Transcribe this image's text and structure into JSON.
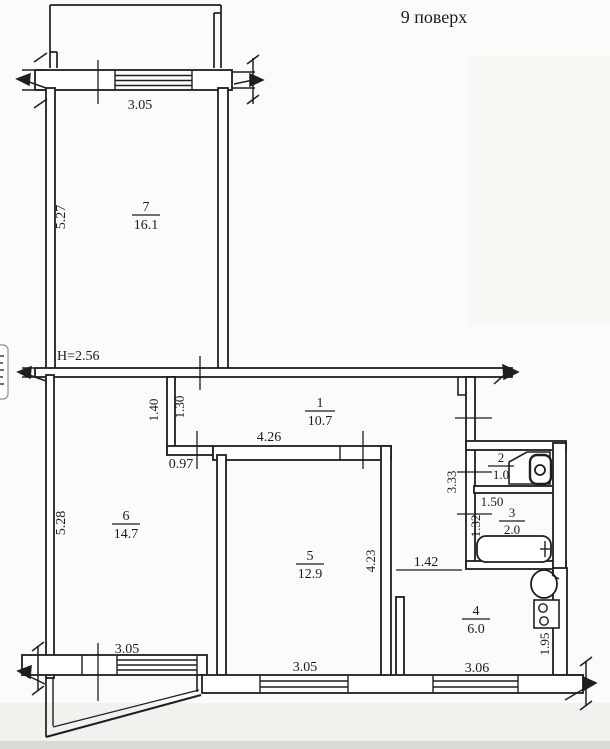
{
  "title": "9 поверх",
  "colors": {
    "ink": "#1c1c1c",
    "paper": "#fbfbf9"
  },
  "rooms": {
    "r1": {
      "number": "1",
      "area": "10.7"
    },
    "r2": {
      "number": "2",
      "area": "1.0"
    },
    "r3": {
      "number": "3",
      "area": "2.0"
    },
    "r4": {
      "number": "4",
      "area": "6.0"
    },
    "r5": {
      "number": "5",
      "area": "12.9"
    },
    "r6": {
      "number": "6",
      "area": "14.7"
    },
    "r7": {
      "number": "7",
      "area": "16.1"
    }
  },
  "dimensions": {
    "top_window": "3.05",
    "room7_side": "5.27",
    "ceiling_height": "H=2.56",
    "hall_1_40": "1.40",
    "hall_1_30": "1.30",
    "hall_4_26": "4.26",
    "hall_0_97": "0.97",
    "room6_side": "5.28",
    "room6_window": "3.05",
    "room5_side": "4.23",
    "room5_window": "3.05",
    "kitchen_pass": "1.42",
    "kitchen_window": "3.06",
    "kitchen_1_95": "1.95",
    "san_3_33": "3.33",
    "bath_1_50": "1.50",
    "bath_1_32": "1.32"
  }
}
